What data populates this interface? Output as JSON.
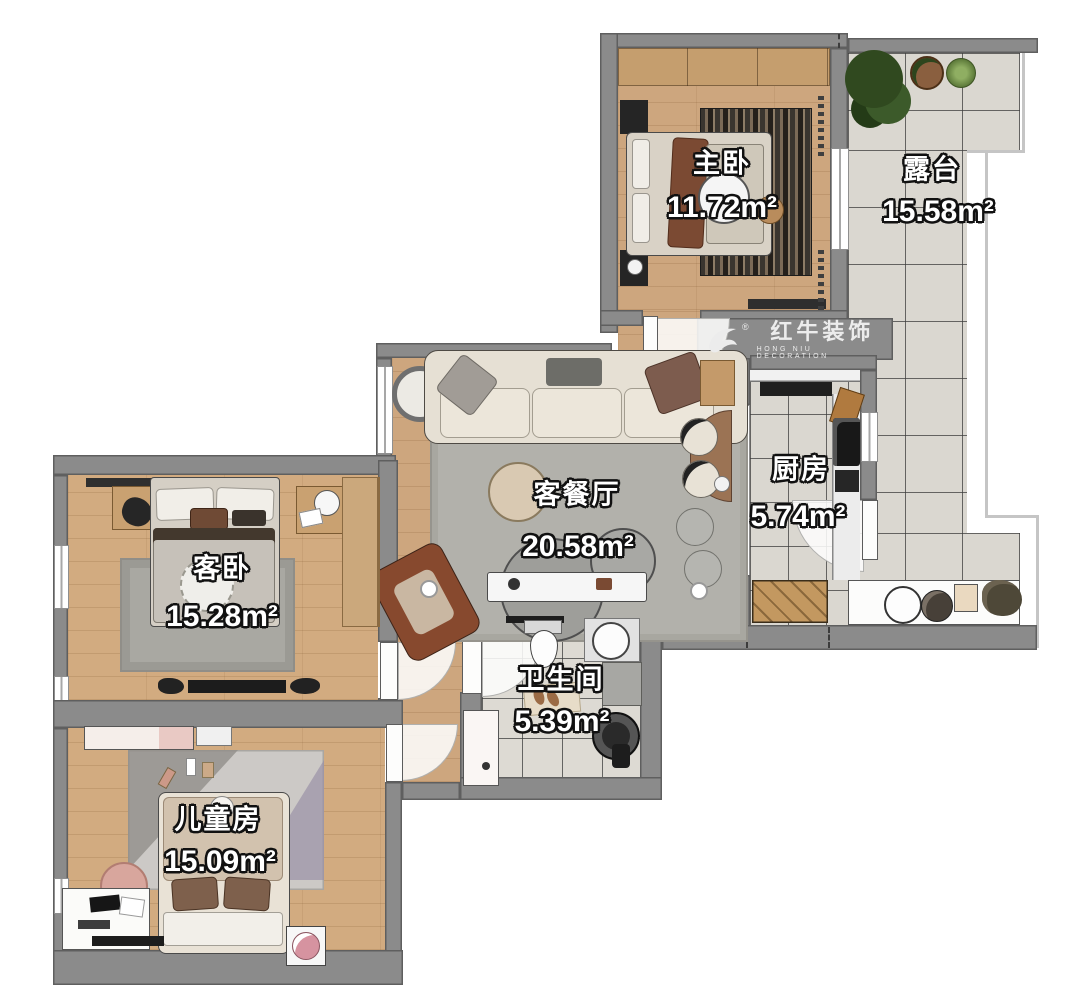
{
  "plan": {
    "title": "apartment floor plan",
    "rooms": [
      {
        "id": "master",
        "name": "主卧",
        "area": "11.72m²"
      },
      {
        "id": "terrace",
        "name": "露台",
        "area": "15.58m²"
      },
      {
        "id": "kitchen",
        "name": "厨房",
        "area": "5.74m²"
      },
      {
        "id": "living",
        "name": "客餐厅",
        "area": "20.58m²"
      },
      {
        "id": "guest",
        "name": "客卧",
        "area": "15.28m²"
      },
      {
        "id": "bath",
        "name": "卫生间",
        "area": "5.39m²"
      },
      {
        "id": "kids",
        "name": "儿童房",
        "area": "15.09m²"
      }
    ],
    "logo": {
      "brand": "红牛装饰",
      "subtitle": "HONG NIU DECORATION",
      "registered": "®"
    },
    "colors": {
      "wall": "#8b8b8b",
      "wood_floor": "#cda67e",
      "tile_floor": "#dad7d0",
      "rug": "#b2b1ab",
      "accent_chair": "#87492e",
      "logo_text": "#ececec"
    }
  }
}
